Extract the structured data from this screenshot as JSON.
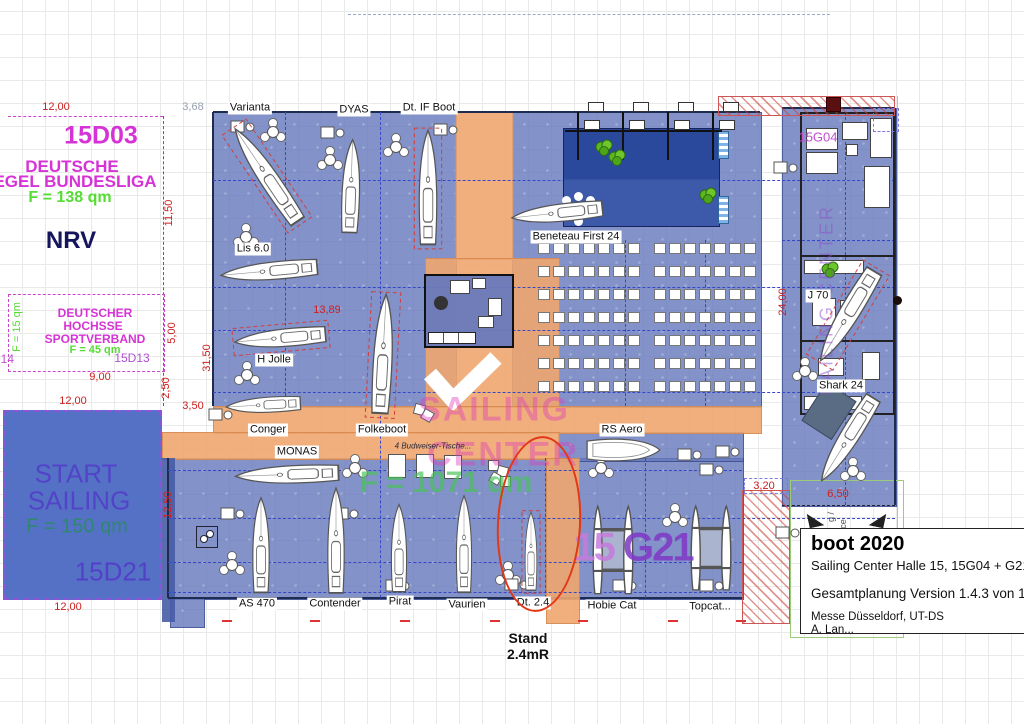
{
  "colors": {
    "hall_blue": "#7a8cc2",
    "walkway_orange": "#eeab76",
    "stage_navy": "#2c499b",
    "start_blue": "#5571c5",
    "dimension_red": "#cc2020",
    "stand_magenta": "#d633d6",
    "area_green": "#55dd33",
    "purple": "#6f49cf",
    "highlight_red": "#e23818"
  },
  "stand_d03": {
    "code": "15D03",
    "name_line1": "DEUTSCHE",
    "name_line2": "EGEL BUNDESLIGA",
    "area": "F = 138 qm",
    "org": "NRV"
  },
  "stand_d13": {
    "name_line1": "DEUTSCHER",
    "name_line2": "HOCHSSE",
    "name_line3": "SPORTVERBAND",
    "area": "F = 45 qm",
    "code": "15D13",
    "side_area": "F = 15 qm",
    "side_code": "D14"
  },
  "stand_d21": {
    "name_line1": "START",
    "name_line2": "SAILING",
    "area": "F = 150 qm",
    "code": "15D21"
  },
  "sailing_center": {
    "line1": "SAILING",
    "line2": "CENTER",
    "area": "F = 1071 qm",
    "note": "4 Budweiser-Tische...",
    "code_left": "15 ",
    "code_right": "G21",
    "code_g04": "15G04",
    "vertical_text": "SAILING CENTER"
  },
  "annotations": {
    "stand_line1": "Stand",
    "stand_line2": "2.4mR",
    "frag1": "g /",
    "frag2": "ce"
  },
  "title_block": {
    "title": "boot 2020",
    "subtitle": "Sailing Center Halle 15, 15G04 + G21",
    "version": "Gesamtplanung Version 1.4.3 von 1",
    "company": "Messe Düsseldorf, UT-DS",
    "author": "A. Lan..."
  },
  "boat_labels": [
    {
      "t": "Varianta",
      "x": 250,
      "y": 108
    },
    {
      "t": "DYAS",
      "x": 354,
      "y": 110
    },
    {
      "t": "Dt. IF Boot",
      "x": 429,
      "y": 108
    },
    {
      "t": "Lis 6.0",
      "x": 253,
      "y": 249
    },
    {
      "t": "H Jolle",
      "x": 274,
      "y": 360
    },
    {
      "t": "Conger",
      "x": 268,
      "y": 430
    },
    {
      "t": "Folkeboot",
      "x": 382,
      "y": 430
    },
    {
      "t": "MONAS",
      "x": 297,
      "y": 452
    },
    {
      "t": "Beneteau First 24",
      "x": 576,
      "y": 237
    },
    {
      "t": "RS Aero",
      "x": 622,
      "y": 430
    },
    {
      "t": "J 70",
      "x": 818,
      "y": 296
    },
    {
      "t": "Shark 24",
      "x": 841,
      "y": 386
    },
    {
      "t": "AS 470",
      "x": 257,
      "y": 604
    },
    {
      "t": "Contender",
      "x": 335,
      "y": 604
    },
    {
      "t": "Pirat",
      "x": 400,
      "y": 602
    },
    {
      "t": "Vaurien",
      "x": 467,
      "y": 605
    },
    {
      "t": "Dt. 2.4",
      "x": 533,
      "y": 603
    },
    {
      "t": "Hobie Cat",
      "x": 612,
      "y": 606
    },
    {
      "t": "Topcat...",
      "x": 710,
      "y": 607
    }
  ],
  "dimensions": [
    {
      "t": "12,00",
      "x": 56,
      "y": 107
    },
    {
      "t": "3,68",
      "x": 193,
      "y": 107,
      "c": "#98a0b0"
    },
    {
      "t": "11,50",
      "x": 169,
      "y": 213,
      "v": 1
    },
    {
      "t": "5,00",
      "x": 172,
      "y": 333,
      "v": 1
    },
    {
      "t": "9,00",
      "x": 100,
      "y": 377
    },
    {
      "t": "2,50",
      "x": 166,
      "y": 388,
      "v": 1
    },
    {
      "t": "12,00",
      "x": 73,
      "y": 401
    },
    {
      "t": "3,50",
      "x": 193,
      "y": 406
    },
    {
      "t": "12,50",
      "x": 168,
      "y": 505,
      "v": 1
    },
    {
      "t": "12,00",
      "x": 68,
      "y": 607
    },
    {
      "t": "13,89",
      "x": 327,
      "y": 310
    },
    {
      "t": "31,50",
      "x": 207,
      "y": 358,
      "v": 1
    },
    {
      "t": "24,00",
      "x": 783,
      "y": 302,
      "v": 1
    },
    {
      "t": "3,20",
      "x": 764,
      "y": 486
    },
    {
      "t": "6,50",
      "x": 838,
      "y": 494
    }
  ],
  "boats": [
    {
      "n": "Varianta",
      "x": 267,
      "y": 176,
      "r": -34,
      "l": 120,
      "w": 32,
      "type": "mono",
      "dash": true
    },
    {
      "n": "DYAS",
      "x": 351,
      "y": 187,
      "r": 2,
      "l": 100,
      "w": 30,
      "type": "mono"
    },
    {
      "n": "Dt IF Boot",
      "x": 428,
      "y": 188,
      "r": 0,
      "l": 123,
      "w": 30,
      "type": "mono",
      "dash": true
    },
    {
      "n": "Lis 6.0",
      "x": 270,
      "y": 271,
      "r": -95,
      "l": 104,
      "w": 30,
      "type": "mono"
    },
    {
      "n": "H Jolle",
      "x": 281,
      "y": 338,
      "r": -95,
      "l": 98,
      "w": 30,
      "type": "mono",
      "dash": true
    },
    {
      "n": "Folkeboot",
      "x": 383,
      "y": 355,
      "r": 3,
      "l": 128,
      "w": 32,
      "type": "mono",
      "dash": true
    },
    {
      "n": "Conger",
      "x": 264,
      "y": 405,
      "r": -93,
      "l": 80,
      "w": 26,
      "type": "mono"
    },
    {
      "n": "MONAS",
      "x": 288,
      "y": 474,
      "r": -92,
      "l": 111,
      "w": 30,
      "type": "mono"
    },
    {
      "n": "Beneteau First 24",
      "x": 558,
      "y": 213,
      "r": -96,
      "l": 98,
      "w": 30,
      "type": "mono"
    },
    {
      "n": "RS Aero",
      "x": 622,
      "y": 450,
      "r": 90,
      "l": 80,
      "w": 28,
      "type": "dinghy"
    },
    {
      "n": "J 70",
      "x": 848,
      "y": 315,
      "r": 211,
      "l": 112,
      "w": 34,
      "type": "mono",
      "dash": true
    },
    {
      "n": "Shark 24",
      "x": 848,
      "y": 438,
      "r": 212,
      "l": 105,
      "w": 32,
      "type": "mono"
    },
    {
      "n": "AS 470",
      "x": 261,
      "y": 546,
      "r": 0,
      "l": 102,
      "w": 28,
      "type": "mono"
    },
    {
      "n": "Contender",
      "x": 336,
      "y": 541,
      "r": 0,
      "l": 113,
      "w": 28,
      "type": "mono"
    },
    {
      "n": "Pirat",
      "x": 399,
      "y": 549,
      "r": 0,
      "l": 94,
      "w": 26,
      "type": "mono"
    },
    {
      "n": "Vaurien",
      "x": 464,
      "y": 545,
      "r": 0,
      "l": 104,
      "w": 26,
      "type": "mono"
    },
    {
      "n": "Dt 2.4",
      "x": 531,
      "y": 552,
      "r": 0,
      "l": 84,
      "w": 20,
      "type": "mono",
      "dash": true
    },
    {
      "n": "Hobie Cat",
      "x": 613,
      "y": 550,
      "r": 0,
      "l": 96,
      "w": 42,
      "type": "cat"
    },
    {
      "n": "Topcat",
      "x": 711,
      "y": 548,
      "r": 0,
      "l": 92,
      "w": 42,
      "type": "cat"
    }
  ],
  "furniture": {
    "tables3": [
      [
        273,
        132
      ],
      [
        330,
        160
      ],
      [
        396,
        147
      ],
      [
        246,
        237
      ],
      [
        247,
        375
      ],
      [
        232,
        565
      ],
      [
        355,
        468
      ],
      [
        508,
        575
      ],
      [
        601,
        468
      ],
      [
        675,
        517
      ],
      [
        805,
        371
      ],
      [
        853,
        471
      ]
    ],
    "desks": [
      [
        243,
        127
      ],
      [
        333,
        133
      ],
      [
        446,
        130
      ],
      [
        221,
        415
      ],
      [
        233,
        514
      ],
      [
        347,
        514
      ],
      [
        398,
        586
      ],
      [
        517,
        585
      ],
      [
        625,
        586
      ],
      [
        712,
        586
      ],
      [
        786,
        168
      ],
      [
        690,
        455
      ],
      [
        712,
        470
      ],
      [
        728,
        452
      ],
      [
        788,
        533
      ]
    ],
    "plants": [
      [
        604,
        148
      ],
      [
        617,
        158
      ],
      [
        708,
        196
      ],
      [
        830,
        270
      ]
    ],
    "crates": [
      [
        488,
        460
      ],
      [
        497,
        466
      ],
      [
        490,
        473
      ],
      [
        500,
        476
      ],
      [
        414,
        404
      ],
      [
        422,
        410
      ]
    ],
    "counter_tables": [
      [
        396,
        465
      ],
      [
        424,
        465
      ],
      [
        452,
        466
      ]
    ],
    "stage_dots": [
      [
        566,
        200
      ],
      [
        578,
        196
      ],
      [
        590,
        200
      ],
      [
        572,
        210
      ],
      [
        584,
        211
      ],
      [
        594,
        208
      ],
      [
        578,
        221
      ]
    ]
  },
  "audience": {
    "rows": 7,
    "cols": 7,
    "dx": 15,
    "dy": 23,
    "w": 10,
    "h": 9,
    "blocks": [
      [
        538,
        243
      ],
      [
        654,
        243
      ]
    ]
  }
}
